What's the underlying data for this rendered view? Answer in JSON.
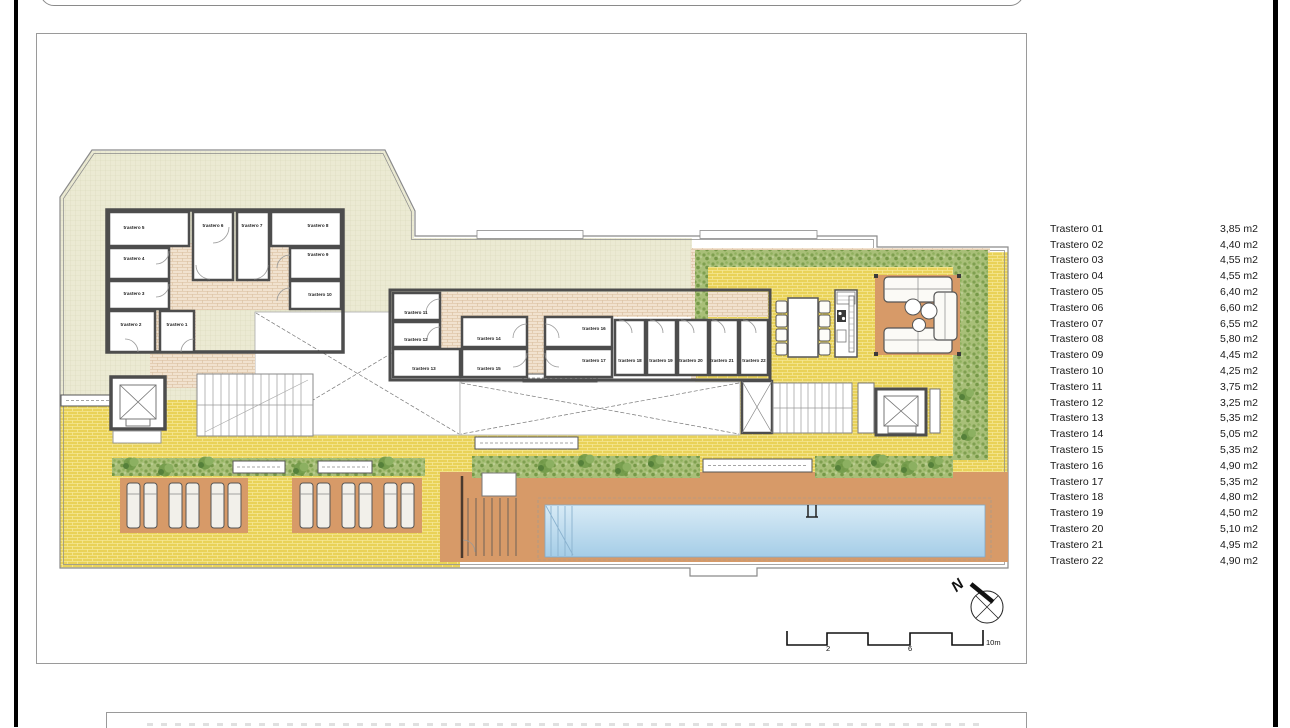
{
  "plan": {
    "rooms": [
      "trastero 1",
      "trastero 2",
      "trastero 3",
      "trastero 4",
      "trastero 5",
      "trastero 6",
      "trastero 7",
      "trastero 8",
      "trastero 9",
      "trastero 10",
      "trastero 11",
      "trastero 12",
      "trastero 13",
      "trastero 14",
      "trastero 15",
      "trastero 16",
      "trastero 17",
      "trastero 18",
      "trastero 19",
      "trastero 20",
      "trastero 21",
      "trastero 22"
    ],
    "north_label": "N",
    "scale_labels": [
      "2",
      "6",
      "10m"
    ],
    "colors": {
      "terrace": "#ebead3",
      "paving_yellow": "#e9d258",
      "corridor_brick": "#f1e2cf",
      "terracotta": "#d79a68",
      "pool_blue": "#aed2e9",
      "hedge_green": "#a8bf78",
      "walls": "#4d4d4d"
    }
  },
  "legend": {
    "items": [
      {
        "name": "Trastero 01",
        "area": "3,85 m2"
      },
      {
        "name": "Trastero 02",
        "area": "4,40 m2"
      },
      {
        "name": "Trastero 03",
        "area": "4,55 m2"
      },
      {
        "name": "Trastero 04",
        "area": "4,55 m2"
      },
      {
        "name": "Trastero 05",
        "area": "6,40 m2"
      },
      {
        "name": "Trastero 06",
        "area": "6,60 m2"
      },
      {
        "name": "Trastero 07",
        "area": "6,55 m2"
      },
      {
        "name": "Trastero 08",
        "area": "5,80 m2"
      },
      {
        "name": "Trastero 09",
        "area": "4,45 m2"
      },
      {
        "name": "Trastero 10",
        "area": "4,25 m2"
      },
      {
        "name": "Trastero 11",
        "area": "3,75 m2"
      },
      {
        "name": "Trastero 12",
        "area": "3,25 m2"
      },
      {
        "name": "Trastero 13",
        "area": "5,35 m2"
      },
      {
        "name": "Trastero 14",
        "area": "5,05 m2"
      },
      {
        "name": "Trastero 15",
        "area": "5,35 m2"
      },
      {
        "name": "Trastero 16",
        "area": "4,90 m2"
      },
      {
        "name": "Trastero 17",
        "area": "5,35 m2"
      },
      {
        "name": "Trastero 18",
        "area": "4,80 m2"
      },
      {
        "name": "Trastero 19",
        "area": "4,50 m2"
      },
      {
        "name": "Trastero 20",
        "area": "5,10 m2"
      },
      {
        "name": "Trastero 21",
        "area": "4,95 m2"
      },
      {
        "name": "Trastero 22",
        "area": "4,90 m2"
      }
    ]
  }
}
